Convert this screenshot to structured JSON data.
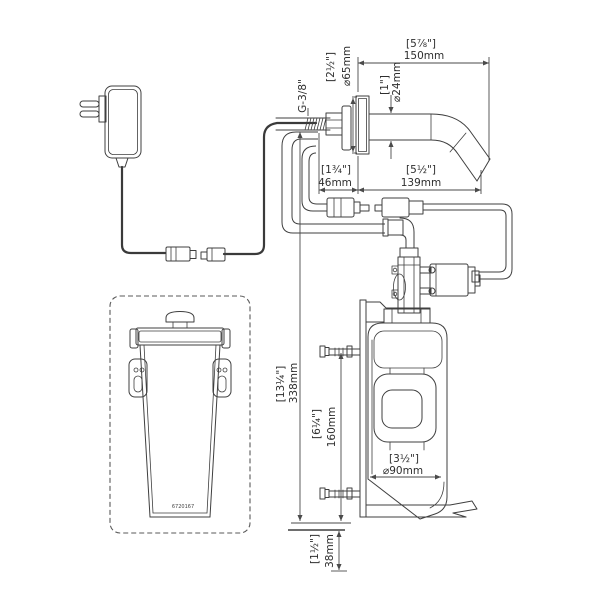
{
  "title": "sensor-soap-dispenser-installation-diagram",
  "colors": {
    "background": "#ffffff",
    "line": "#3f3f3f",
    "text": "#2e2e2e"
  },
  "dims": {
    "thread": "G-3/8\"",
    "flange_in": "[2½\"]",
    "flange_mm": "⌀65mm",
    "top_reach_in": "[5⅞\"]",
    "top_reach_mm": "150mm",
    "spout_dia_in": "[1\"]",
    "spout_dia_mm": "⌀24mm",
    "shank_in": "[1¾\"]",
    "shank_mm": "46mm",
    "reach_in": "[5½\"]",
    "reach_mm": "139mm",
    "height_in": "[13¼\"]",
    "height_mm": "338mm",
    "mid_in": "[6¼\"]",
    "mid_mm": "160mm",
    "bottle_dia_in": "[3½\"]",
    "bottle_dia_mm": "⌀90mm",
    "bottom_in": "[1½\"]",
    "bottom_mm": "38mm"
  },
  "labels": {
    "refill_bottle_code": "6720167"
  },
  "parts": [
    "power-adapter",
    "dc-connector-pair",
    "sensor-cable-connectors",
    "wall-mounted-spout",
    "soap-tube",
    "elbow-fitting",
    "soap-pump",
    "pump-motor",
    "wall-bracket",
    "mounting-screws",
    "dispenser-bottle",
    "refill-bottle"
  ]
}
